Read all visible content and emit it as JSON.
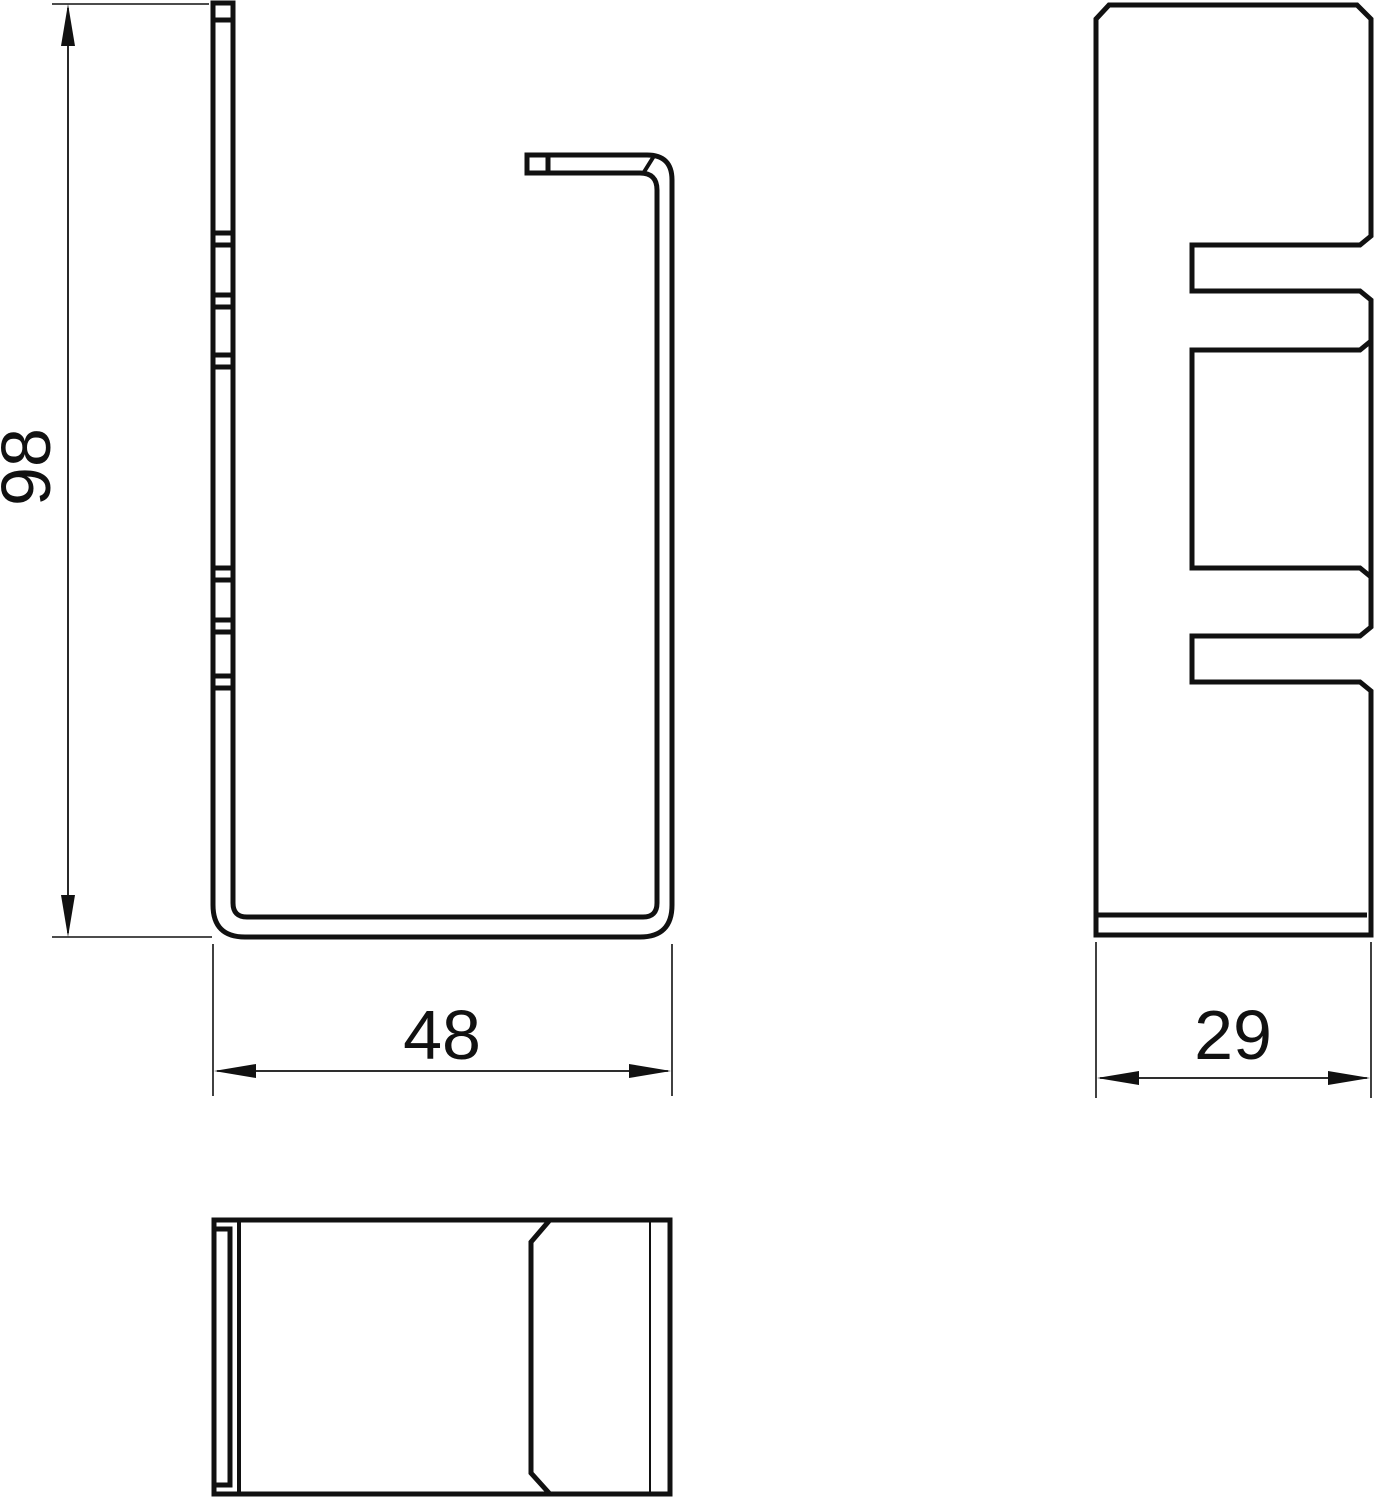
{
  "canvas": {
    "background": "#ffffff",
    "line_color": "#111111"
  },
  "dimensions": {
    "height": {
      "value": "98"
    },
    "width": {
      "value": "48"
    },
    "depth": {
      "value": "29"
    }
  }
}
